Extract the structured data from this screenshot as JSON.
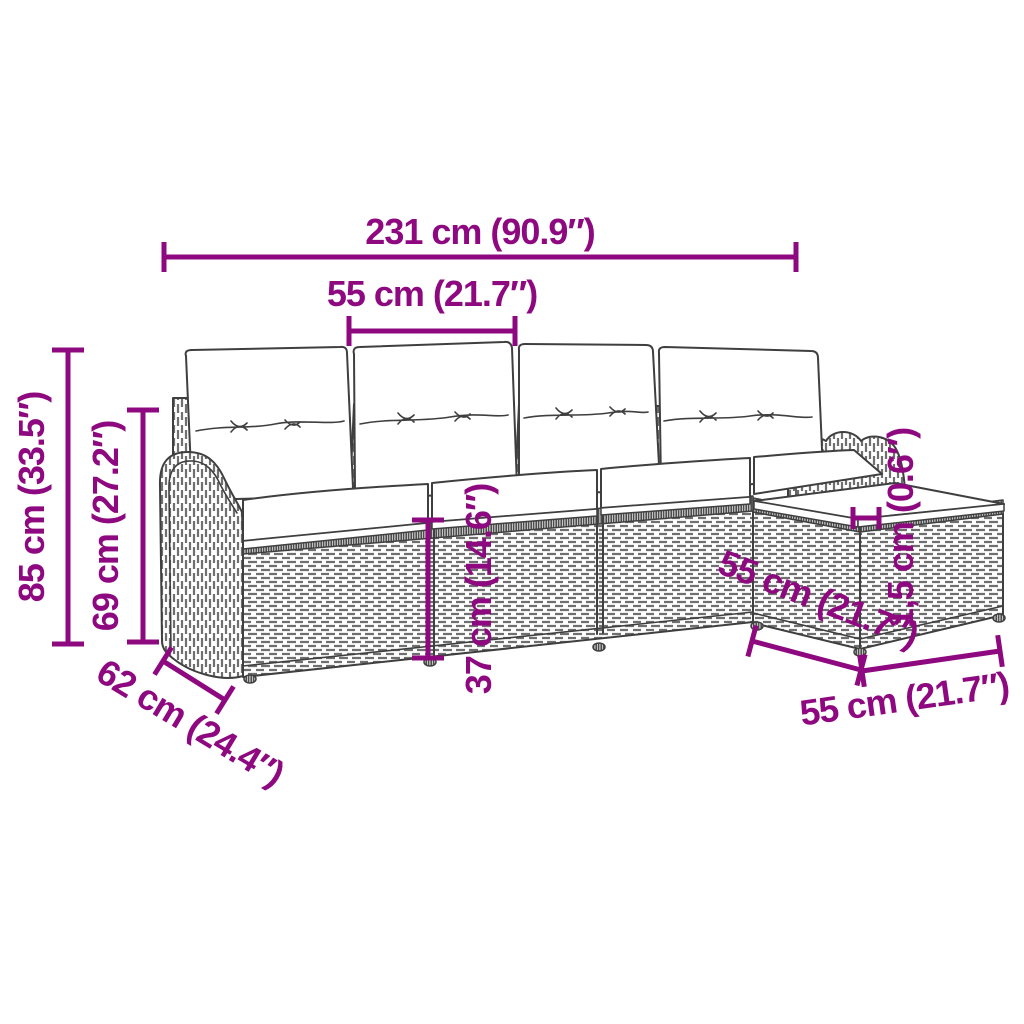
{
  "colors": {
    "accent": "#8e0980",
    "artwork_line": "#3f3f3f"
  },
  "labels": {
    "total_width": "231 cm (90.9″)",
    "seat_module_width": "55 cm (21.7″)",
    "total_height": "85 cm (33.5″)",
    "backrest_height": "69 cm (27.2″)",
    "seat_height": "37 cm (14.6″)",
    "cushion_thickness": "1,5 cm (0.6″)",
    "ottoman_depth": "55 cm (21.7″)",
    "ottoman_width": "55 cm (21.7″)",
    "sofa_depth": "62 cm (24.4″)"
  }
}
